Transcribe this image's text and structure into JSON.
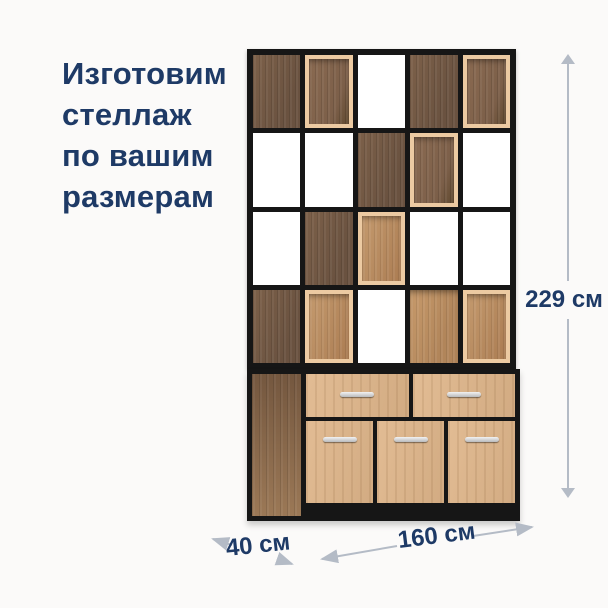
{
  "page": {
    "background": "#fbfaf9"
  },
  "headline": {
    "lines": [
      "Изготовим",
      "стеллаж",
      "по вашим",
      "размерам"
    ],
    "color": "#1e3a66"
  },
  "dimensions": {
    "height": {
      "label": "229 см"
    },
    "width": {
      "label": "160 см"
    },
    "depth": {
      "label": "40 см"
    },
    "arrow_color": "#b4bbc6",
    "label_color": "#1e3a66"
  },
  "shelf": {
    "frame_color": "#161616",
    "palette": {
      "dark_wood": "#6a5240",
      "dark_wood_light": "#7c6049",
      "oak": "#b1855a",
      "box_frame": "#eccaa2",
      "box_interior_dark": "#7c5f49",
      "box_interior_light": "#c49a6e",
      "front_wood": "#dcb68e",
      "base_side": "#8a684c",
      "handle": "#b9babc"
    },
    "grid": {
      "columns": 5,
      "rows": 4,
      "cells": [
        [
          "dark",
          "box-dark",
          "open",
          "dark",
          "box-dark"
        ],
        [
          "open",
          "open",
          "dark",
          "box-dark",
          "open"
        ],
        [
          "open",
          "dark",
          "box-light",
          "open",
          "open"
        ],
        [
          "dark",
          "box-light",
          "open",
          "oak",
          "box-light"
        ]
      ]
    },
    "base": {
      "drawers": [
        "drawer",
        "drawer"
      ],
      "doors": [
        "door",
        "door",
        "door"
      ]
    }
  }
}
